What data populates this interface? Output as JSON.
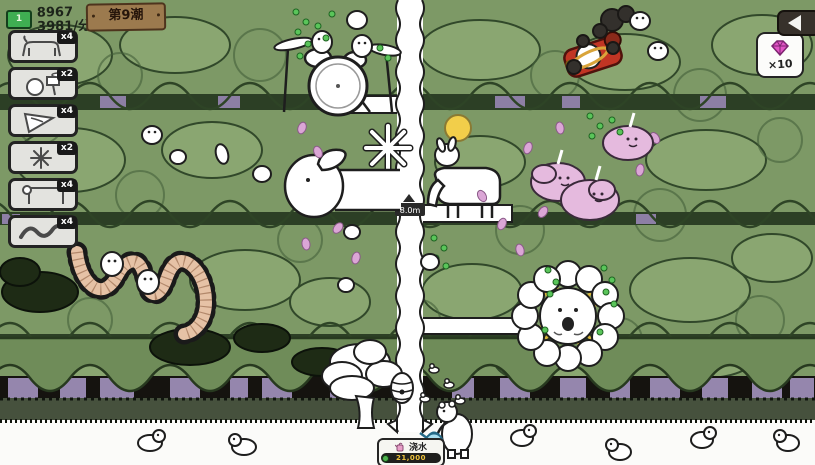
{
  "hud": {
    "currency": {
      "icon": "money-bill-icon",
      "amount": "8967",
      "rate": "3981/分钟"
    },
    "wave_sign": "第9潮",
    "back_button": {
      "icon": "back-arrow-icon"
    },
    "reward": {
      "icon": "diamond-icon",
      "count": "×10",
      "color": "#e154c4"
    }
  },
  "sidebar": {
    "cards": [
      {
        "id": "horse",
        "icon": "horse-unit-icon",
        "count": "x4"
      },
      {
        "id": "drum-kit",
        "icon": "drum-kit-icon",
        "count": "x2"
      },
      {
        "id": "drill",
        "icon": "drill-top-icon",
        "count": "x4"
      },
      {
        "id": "splat",
        "icon": "splat-star-icon",
        "count": "x2"
      },
      {
        "id": "goose",
        "icon": "goose-icon",
        "count": "x4"
      },
      {
        "id": "worm",
        "icon": "worm-icon",
        "count": "x4"
      }
    ]
  },
  "action_panel": {
    "icon": "watering-can-icon",
    "label": "浇水",
    "cost": "21,000",
    "cost_icon": "coin-icon"
  },
  "scene": {
    "path_sign": "8.0m"
  },
  "colors": {
    "forest": "#7d9966",
    "forest_dark": "#2c3f25",
    "trunk_purple": "#9586ad",
    "drop_green": "#5ac55a",
    "petal_pink": "#dba6d6",
    "cloud_pink": "#e5bade",
    "enemy_red": "#c13524",
    "ring_yellow": "#d9a43a",
    "cost_yellow": "#eec33c"
  }
}
